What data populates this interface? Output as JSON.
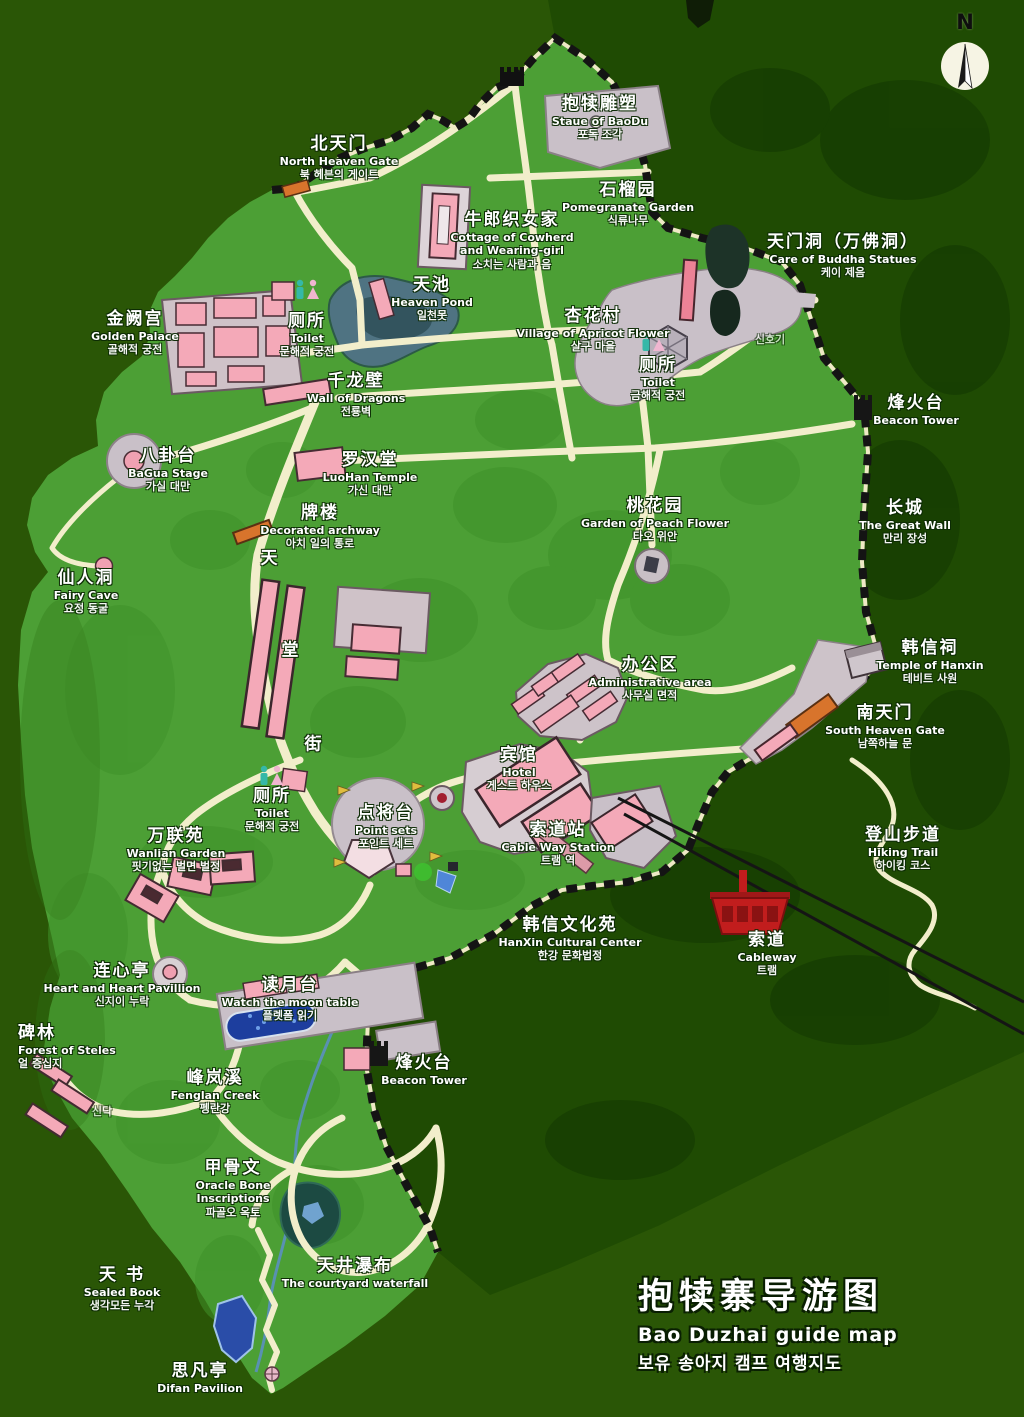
{
  "map": {
    "title": {
      "zh": "抱犊寨导游图",
      "en": "Bao Duzhai guide map",
      "ko": "보유 송아지 캠프 여행지도"
    },
    "compass": {
      "label": "N"
    },
    "street": {
      "name": "天堂街",
      "chars": [
        {
          "ch": "天",
          "x": 269,
          "y": 556
        },
        {
          "ch": "堂",
          "x": 290,
          "y": 648
        },
        {
          "ch": "街",
          "x": 313,
          "y": 742
        }
      ]
    },
    "colors": {
      "background": "#2a5606",
      "dark_forest": "#1f4b03",
      "plateau_green": "#4c9f35",
      "path_cream": "#f2eecb",
      "building_pink": "#f4a9b8",
      "plaza_gray": "#c9c0c8",
      "gate_orange": "#d8742c",
      "wall_black": "#141414",
      "water_blue": "#4f7382",
      "pool_blue": "#1d3e9e",
      "cable_red": "#c11d1d",
      "label_white": "#ffffff"
    },
    "labels": [
      {
        "id": "north-heaven-gate",
        "x": 339,
        "y": 134,
        "zh": "北天门",
        "en": "North Heaven Gate",
        "ko": "북 헤븐의 게이트"
      },
      {
        "id": "baodu-statue",
        "x": 600,
        "y": 94,
        "zh": "抱犊雕塑",
        "en": "Staue of BaoDu",
        "ko": "포독 조각"
      },
      {
        "id": "pomegranate-garden",
        "x": 628,
        "y": 180,
        "zh": "石榴园",
        "en": "Pomegranate Garden",
        "ko": "식류나무"
      },
      {
        "id": "cowherd-cottage",
        "x": 512,
        "y": 210,
        "cls": "pre",
        "zh": "牛郎织女家",
        "en": "Cottage of Cowherd\nand Wearing-girl",
        "ko": "소치는 사람과 음"
      },
      {
        "id": "heaven-pond",
        "x": 432,
        "y": 275,
        "zh": "天池",
        "en": "Heaven Pond",
        "ko": "일천못"
      },
      {
        "id": "tianmen-cave",
        "x": 843,
        "y": 232,
        "zh": "天门洞（万佛洞）",
        "en": "Care of Buddha Statues",
        "ko": "케이 제음"
      },
      {
        "id": "golden-palace",
        "x": 135,
        "y": 309,
        "zh": "金阙宫",
        "en": "Golden Palace",
        "ko": "골해적 궁전"
      },
      {
        "id": "toilet-north",
        "x": 307,
        "y": 311,
        "zh": "厕所",
        "en": "Toilet",
        "ko": "문해적 궁전"
      },
      {
        "id": "apricot-village",
        "x": 593,
        "y": 306,
        "zh": "杏花村",
        "en": "Village of Apricot Flower",
        "ko": "살구 마을"
      },
      {
        "id": "toilet-apricot",
        "x": 658,
        "y": 355,
        "zh": "厕所",
        "en": "Toilet",
        "ko": "금해적 궁전"
      },
      {
        "id": "signal",
        "x": 770,
        "y": 333,
        "cls": "faint",
        "ko": "신호기"
      },
      {
        "id": "dragon-wall",
        "x": 356,
        "y": 371,
        "zh": "千龙壁",
        "en": "Wall of Dragons",
        "ko": "전룡벽"
      },
      {
        "id": "beacon-tower-ne",
        "x": 916,
        "y": 393,
        "zh": "烽火台",
        "en": "Beacon Tower"
      },
      {
        "id": "bagua-stage",
        "x": 168,
        "y": 446,
        "zh": "八卦台",
        "en": "BaGua Stage",
        "ko": "가실 대만"
      },
      {
        "id": "luohan-temple",
        "x": 370,
        "y": 450,
        "zh": "罗汉堂",
        "en": "LuoHan Temple",
        "ko": "가신 대만"
      },
      {
        "id": "decorated-archway",
        "x": 320,
        "y": 503,
        "zh": "牌楼",
        "en": "Decorated archway",
        "ko": "아치 일의 통로"
      },
      {
        "id": "peach-garden",
        "x": 655,
        "y": 496,
        "zh": "桃花园",
        "en": "Garden of Peach Flower",
        "ko": "타오 위안"
      },
      {
        "id": "great-wall",
        "x": 905,
        "y": 498,
        "zh": "长城",
        "en": "The Great Wall",
        "ko": "만리 장성"
      },
      {
        "id": "fairy-cave",
        "x": 86,
        "y": 568,
        "zh": "仙人洞",
        "en": "Fairy Cave",
        "ko": "요정 동굴"
      },
      {
        "id": "hanxin-temple",
        "x": 930,
        "y": 638,
        "zh": "韩信祠",
        "en": "Temple of Hanxin",
        "ko": "테비트 사원"
      },
      {
        "id": "admin-area",
        "x": 650,
        "y": 655,
        "zh": "办公区",
        "en": "Administrative area",
        "ko": "사무실 면적"
      },
      {
        "id": "south-heaven-gate",
        "x": 885,
        "y": 703,
        "zh": "南天门",
        "en": "South Heaven Gate",
        "ko": "남쪽하늘 문"
      },
      {
        "id": "hotel",
        "x": 519,
        "y": 745,
        "zh": "宾馆",
        "en": "Hotel",
        "ko": "게스트 하우스"
      },
      {
        "id": "toilet-south",
        "x": 272,
        "y": 786,
        "zh": "厕所",
        "en": "Toilet",
        "ko": "문해적 궁전"
      },
      {
        "id": "point-sets",
        "x": 386,
        "y": 803,
        "zh": "点将台",
        "en": "Point sets",
        "ko": "포인트 세트"
      },
      {
        "id": "cableway-station",
        "x": 558,
        "y": 820,
        "zh": "索道站",
        "en": "Cable Way Station",
        "ko": "트램 역"
      },
      {
        "id": "wanlian-garden",
        "x": 176,
        "y": 826,
        "zh": "万联苑",
        "en": "Wanlian Garden",
        "ko": "핏기없는 벌면 벌정"
      },
      {
        "id": "hiking-trail",
        "x": 903,
        "y": 825,
        "zh": "登山步道",
        "en": "Hiking Trail",
        "ko": "하이킹 코스"
      },
      {
        "id": "hanxin-cultural",
        "x": 570,
        "y": 915,
        "zh": "韩信文化苑",
        "en": "HanXin Cultural Center",
        "ko": "한강 문화법정"
      },
      {
        "id": "cableway",
        "x": 767,
        "y": 930,
        "zh": "索道",
        "en": "Cableway",
        "ko": "트램"
      },
      {
        "id": "heart-pavilion",
        "x": 122,
        "y": 961,
        "zh": "连心亭",
        "en": "Heart and Heart Pavillion",
        "ko": "신지이 누락"
      },
      {
        "id": "moon-table",
        "x": 290,
        "y": 975,
        "zh": "读月台",
        "en": "Watch the moon table",
        "ko": "플렛폼 읽기"
      },
      {
        "id": "steles-forest",
        "x": 18,
        "y": 1023,
        "cls": "left",
        "zh": "碑林",
        "en": "Forest of Steles",
        "ko": "얼 증십지"
      },
      {
        "id": "beacon-tower-s",
        "x": 424,
        "y": 1053,
        "zh": "烽火台",
        "en": "Beacon Tower"
      },
      {
        "id": "fenglan-creek",
        "x": 215,
        "y": 1068,
        "zh": "峰岚溪",
        "en": "Fenglan Creek",
        "ko": "펭란강"
      },
      {
        "id": "sindak",
        "x": 102,
        "y": 1105,
        "cls": "faint",
        "ko": "신닥"
      },
      {
        "id": "oracle-bone",
        "x": 233,
        "y": 1158,
        "cls": "pre",
        "zh": "甲骨文",
        "en": "Oracle Bone\nInscriptions",
        "ko": "파골오 옥토"
      },
      {
        "id": "sealed-book",
        "x": 122,
        "y": 1265,
        "zh": "天 书",
        "en": "Sealed Book",
        "ko": "생각모든 누각"
      },
      {
        "id": "courtyard-waterfall",
        "x": 355,
        "y": 1256,
        "zh": "天井瀑布",
        "en": "The courtyard waterfall"
      },
      {
        "id": "sifan-pavilion",
        "x": 200,
        "y": 1361,
        "zh": "思凡亭",
        "en": "Difan Pavilion"
      }
    ]
  }
}
